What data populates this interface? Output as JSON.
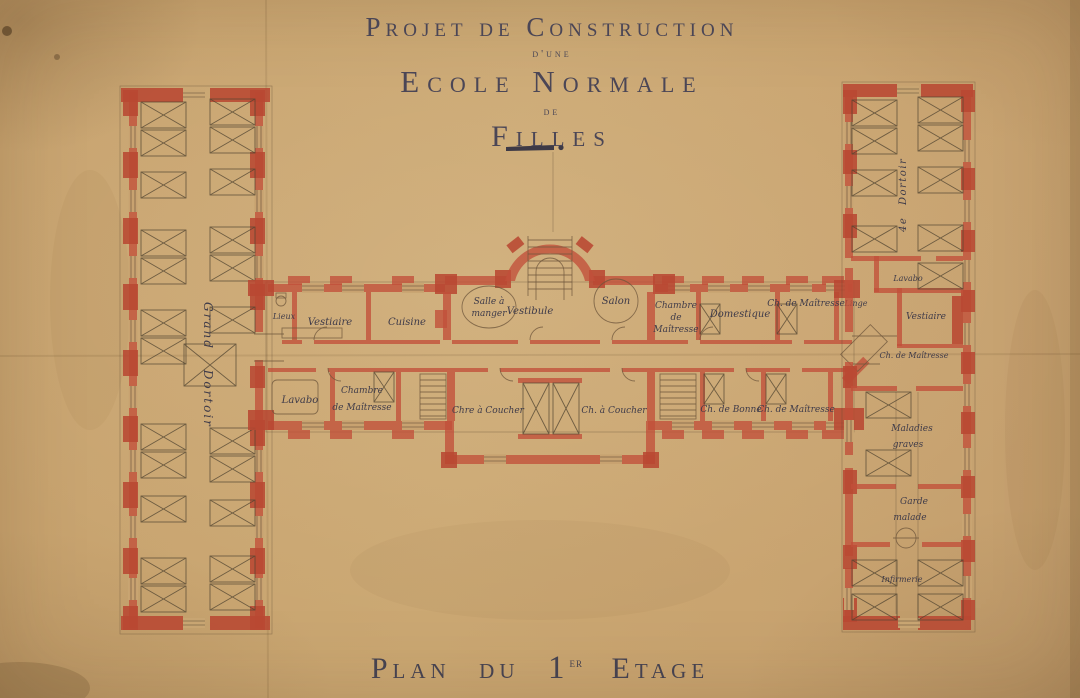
{
  "document": {
    "title_lines": [
      "Projet de Construction",
      "d'une",
      "Ecole Normale",
      "de",
      "Filles"
    ],
    "caption": {
      "prefix": "Plan du",
      "floor_number": "1",
      "floor_exponent": "er",
      "suffix": "Etage"
    }
  },
  "colors": {
    "paper": "#c8a471",
    "wall_red": "#c2503a",
    "ink": "#45414e",
    "pencil": "#6d5940"
  },
  "left_wing": {
    "dormitory": "Grand Dortoir"
  },
  "central_block": {
    "rooms": {
      "lieux": "Lieux",
      "vestiaire": "Vestiaire",
      "cuisine": "Cuisine",
      "salle_a_manger": [
        "Salle à",
        "manger"
      ],
      "vestibule": "Vestibule",
      "salon": "Salon",
      "chambre_de_maitresse": [
        "Chambre",
        "de",
        "Maîtresse"
      ],
      "domestique": "Domestique",
      "ch_de_maitresse": "Ch. de Maîtresse",
      "linge": "Linge",
      "lavabo": "Lavabo",
      "chambre_de_maitresse_2": [
        "Chambre",
        "de Maîtresse"
      ],
      "chambre_a_coucher_1": "Chre à Coucher",
      "chambre_a_coucher_2": "Ch. à Coucher",
      "ch_de_bonne": "Ch. de Bonne",
      "ch_de_maitresse_2": "Ch. de Maîtresse"
    }
  },
  "right_wing": {
    "dormitory": "4e Dortoir",
    "rooms": {
      "lavabo": "Lavabo",
      "vestiaire": "Vestiaire",
      "ch_de_maitresse": "Ch. de Maîtresse",
      "maladies_graves": [
        "Maladies",
        "graves"
      ],
      "garde_malade": [
        "Garde",
        "malade"
      ],
      "infirmerie": "Infirmerie"
    }
  }
}
